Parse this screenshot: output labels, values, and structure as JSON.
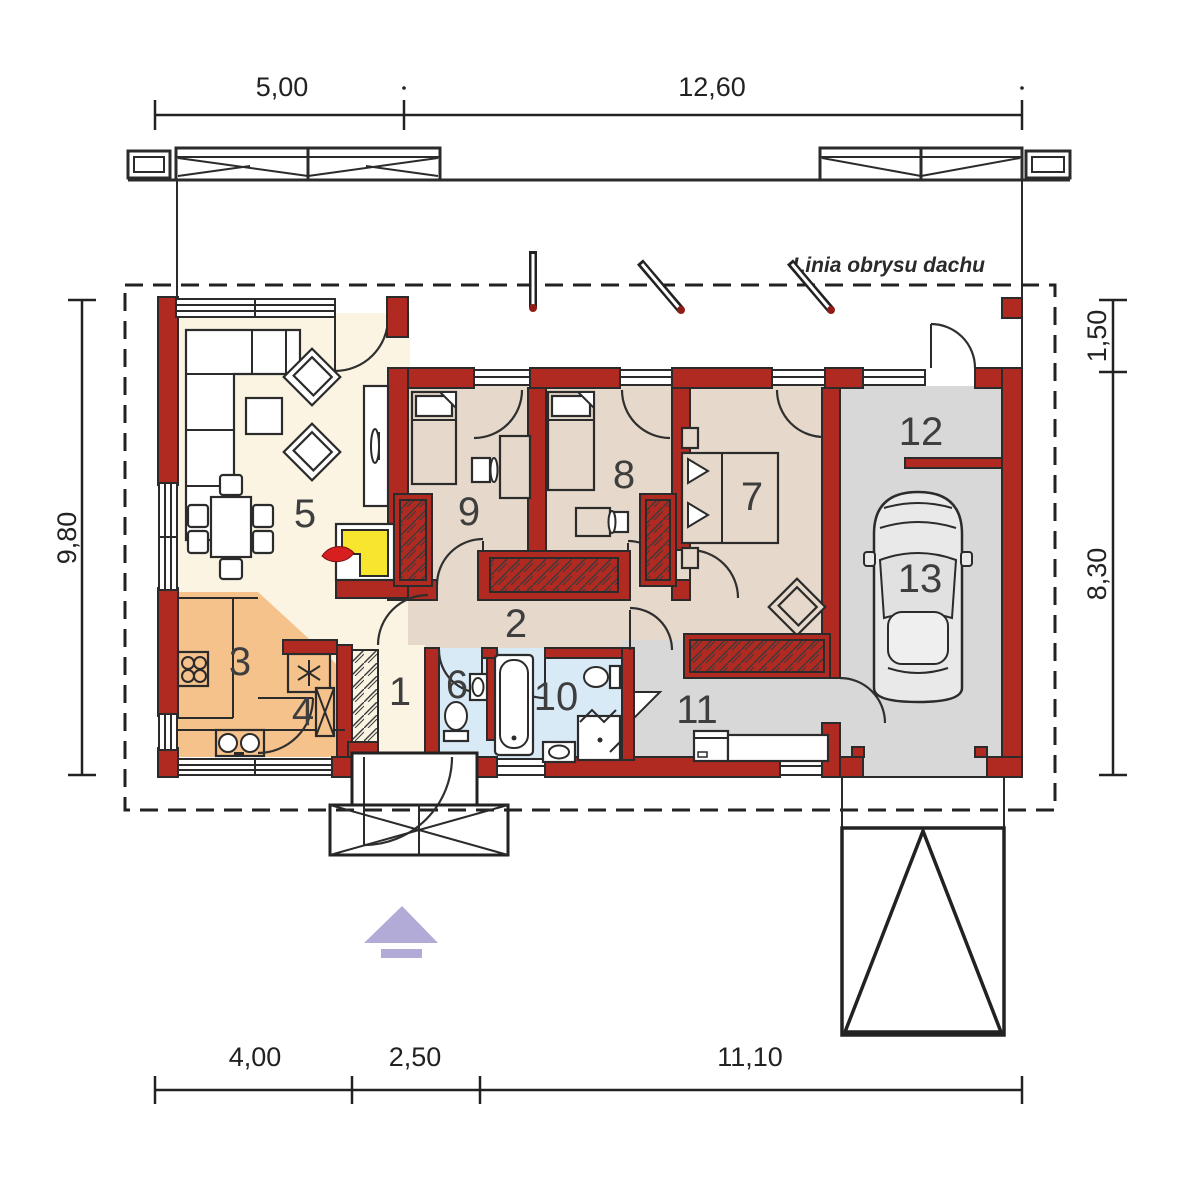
{
  "drawing": {
    "roof_outline_label": "Linia obrysu dachu"
  },
  "dimensions": {
    "top": [
      "5,00",
      "12,60"
    ],
    "right": [
      "1,50",
      "8,30"
    ],
    "left": [
      "9,80"
    ],
    "bottom": [
      "4,00",
      "2,50",
      "11,10"
    ]
  },
  "room_numbers": [
    "1",
    "2",
    "3",
    "4",
    "5",
    "6",
    "7",
    "8",
    "9",
    "10",
    "11",
    "12",
    "13"
  ],
  "colors": {
    "wall": "#b02a22",
    "cream": "#fbf4e3",
    "kitchen": "#f5c28c",
    "tan": "#e6d9cb",
    "blue": "#d9eaf7",
    "gray": "#d8d8d8",
    "yellow": "#f8e52e",
    "flame": "#d81f1f",
    "purple": "#b3abd7",
    "line": "#2b2b2b",
    "dim": "#222222",
    "label": "#3e3e3e"
  }
}
